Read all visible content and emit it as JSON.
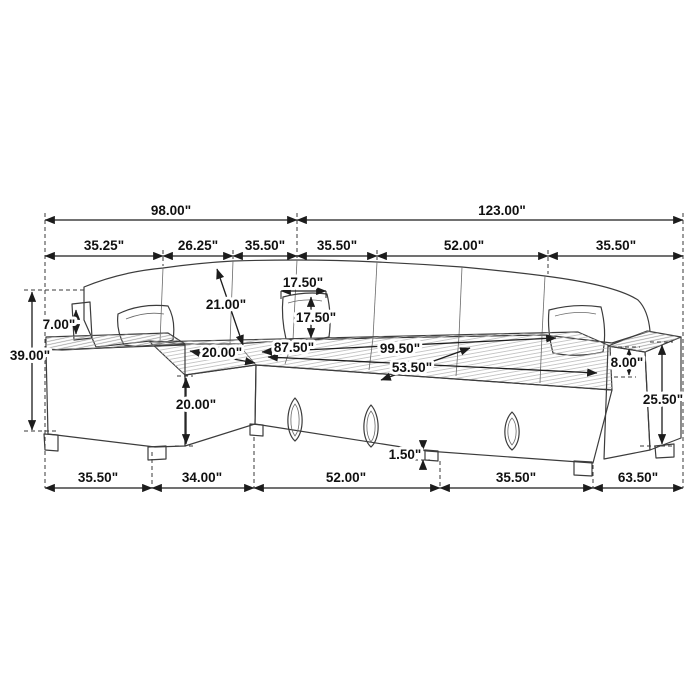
{
  "dims": {
    "top": [
      "98.00\"",
      "123.00\""
    ],
    "upper": [
      "35.25\"",
      "26.25\"",
      "35.50\"",
      "35.50\"",
      "52.00\"",
      "35.50\""
    ],
    "bottom": [
      "35.50\"",
      "34.00\"",
      "52.00\"",
      "35.50\"",
      "63.50\""
    ],
    "left": {
      "overall_height": "39.00\"",
      "back_above_armrest": "7.00\""
    },
    "body": {
      "backrest_diagonal": "21.00\"",
      "pillow_width": "17.50\"",
      "pillow_height": "17.50\"",
      "chaise_seat_width": "20.00\"",
      "inner_length": "87.50\"",
      "overall_diagonal": "99.50\"",
      "sleeper_depth": "53.50\"",
      "chaise_front_height": "20.00\"",
      "armrest_above_seat": "8.00\"",
      "armrest_height": "25.50\"",
      "leg_height": "1.50\""
    }
  }
}
